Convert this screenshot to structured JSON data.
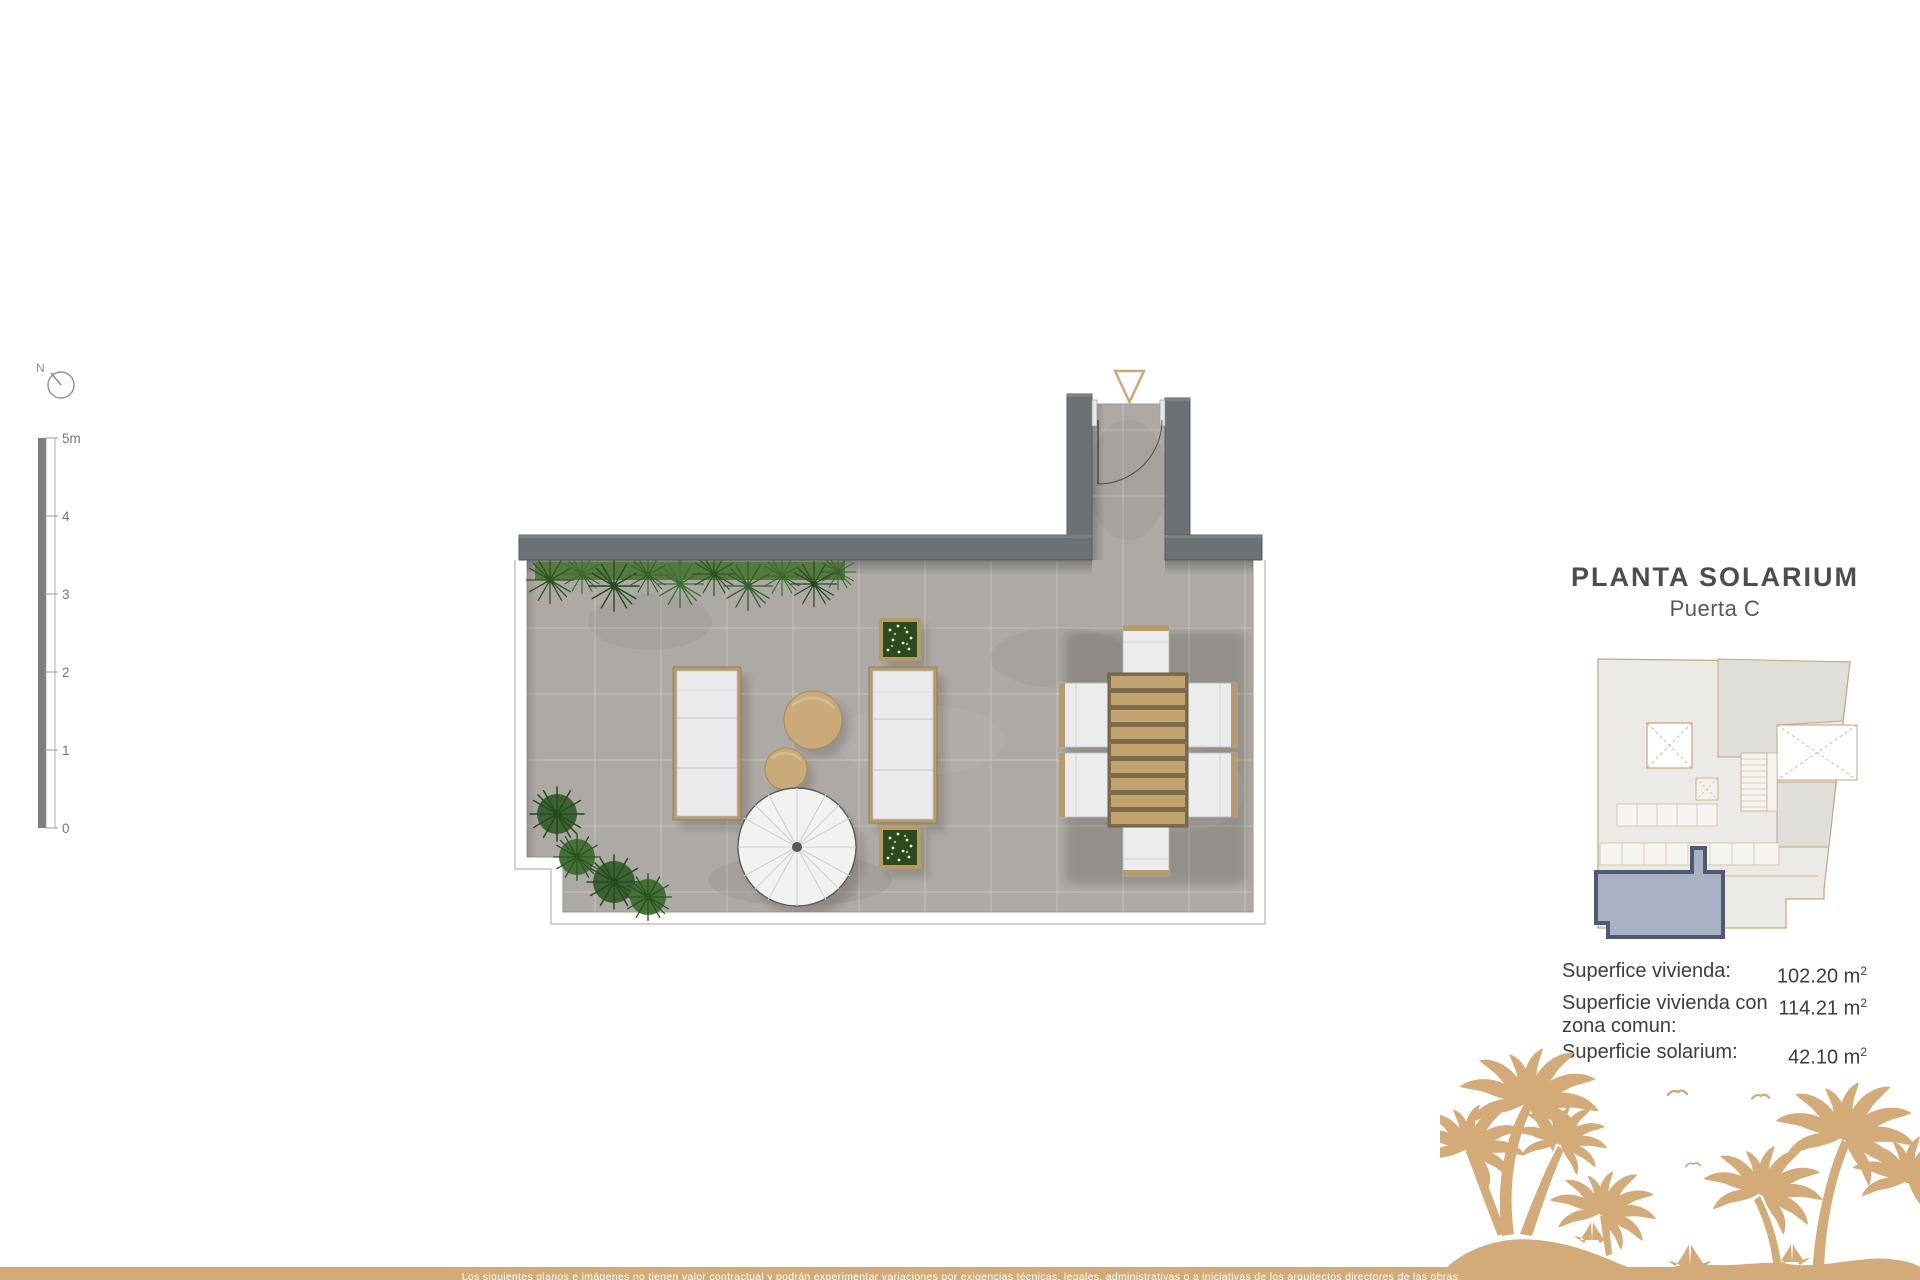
{
  "header": {
    "title": "PLANTA SOLARIUM",
    "subtitle": "Puerta C"
  },
  "compass": {
    "label": "N"
  },
  "scale_bar": {
    "labels": [
      "5m",
      "4",
      "3",
      "2",
      "1",
      "0"
    ]
  },
  "measurements": {
    "unit_base": "m",
    "unit_exp": "2",
    "rows": [
      {
        "label": "Superfice vivienda:",
        "value": "102.20"
      },
      {
        "label": "Superficie vivienda con zona comun:",
        "value": "114.21"
      },
      {
        "label": "Superficie solarium:",
        "value": "42.10"
      }
    ]
  },
  "footer": {
    "disclaimer": "Los siguientes planos e imágenes no tienen valor contractual y podrán experimentar variaciones por exigencias técnicas, legales, administrativas o a iniciativas de los arquitectos directores de las obras"
  },
  "colors": {
    "accent_tan": "#d2ab79",
    "wall_gray": "#6c7273",
    "floor_gray": "#ada9a4",
    "hedge_green": "#47722f",
    "unit_highlight_fill": "#a9b1c4",
    "unit_highlight_stroke": "#4f5a72",
    "keyplan_outline": "#c5a67c",
    "text_dark": "#3e3e3e"
  }
}
